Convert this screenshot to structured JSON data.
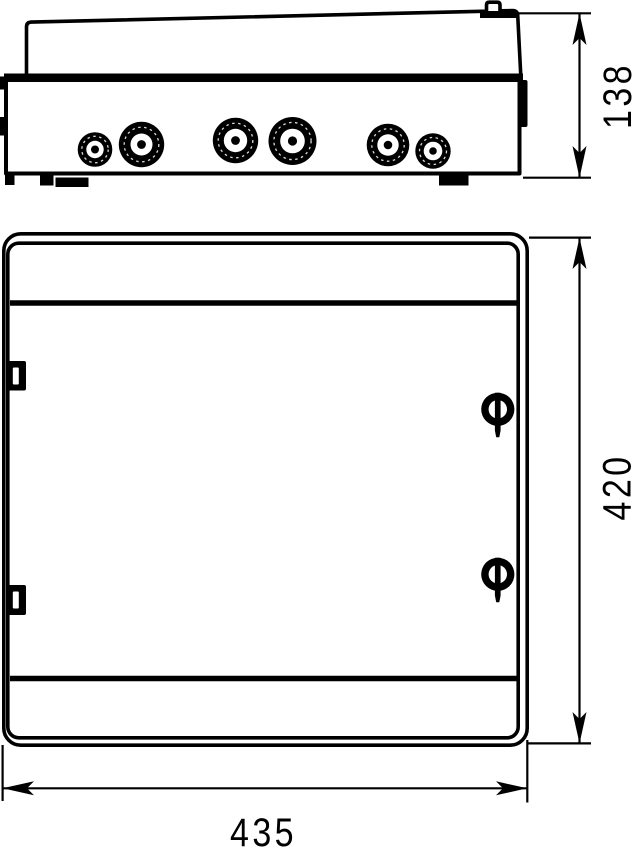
{
  "drawing": {
    "background_color": "#ffffff",
    "line_color": "#000000",
    "type": "technical-dimension-drawing",
    "subject": "electrical-enclosure",
    "top_view": {
      "depth_dimension": "138",
      "knockout_count": 6
    },
    "front_view": {
      "height_dimension": "420",
      "width_dimension": "435",
      "hinge_count": 2,
      "lock_count": 2
    }
  }
}
